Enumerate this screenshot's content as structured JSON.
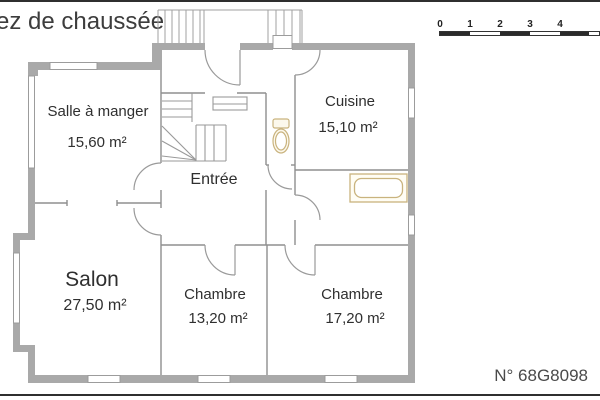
{
  "page": {
    "title": "ez de chaussée",
    "reference": "N° 68G8098"
  },
  "scale_bar": {
    "labels": [
      "0",
      "1",
      "2",
      "3",
      "4"
    ]
  },
  "rooms": [
    {
      "id": "salle-a-manger",
      "name": "Salle à manger",
      "area": "15,60 m²"
    },
    {
      "id": "cuisine",
      "name": "Cuisine",
      "area": "15,10 m²"
    },
    {
      "id": "entree",
      "name": "Entrée",
      "area": ""
    },
    {
      "id": "salon",
      "name": "Salon",
      "area": "27,50 m²"
    },
    {
      "id": "chambre-1",
      "name": "Chambre",
      "area": "13,20 m²"
    },
    {
      "id": "chambre-2",
      "name": "Chambre",
      "area": "17,20 m²"
    }
  ],
  "fixtures": [
    {
      "name": "toilet"
    },
    {
      "name": "bathtub"
    }
  ],
  "colors": {
    "wall": "#a9a9a9",
    "interior_line": "#8f8f8f",
    "fixture_outline": "#c9b37e",
    "text": "#2f2f2f",
    "scale_dark": "#2b2b2b"
  }
}
